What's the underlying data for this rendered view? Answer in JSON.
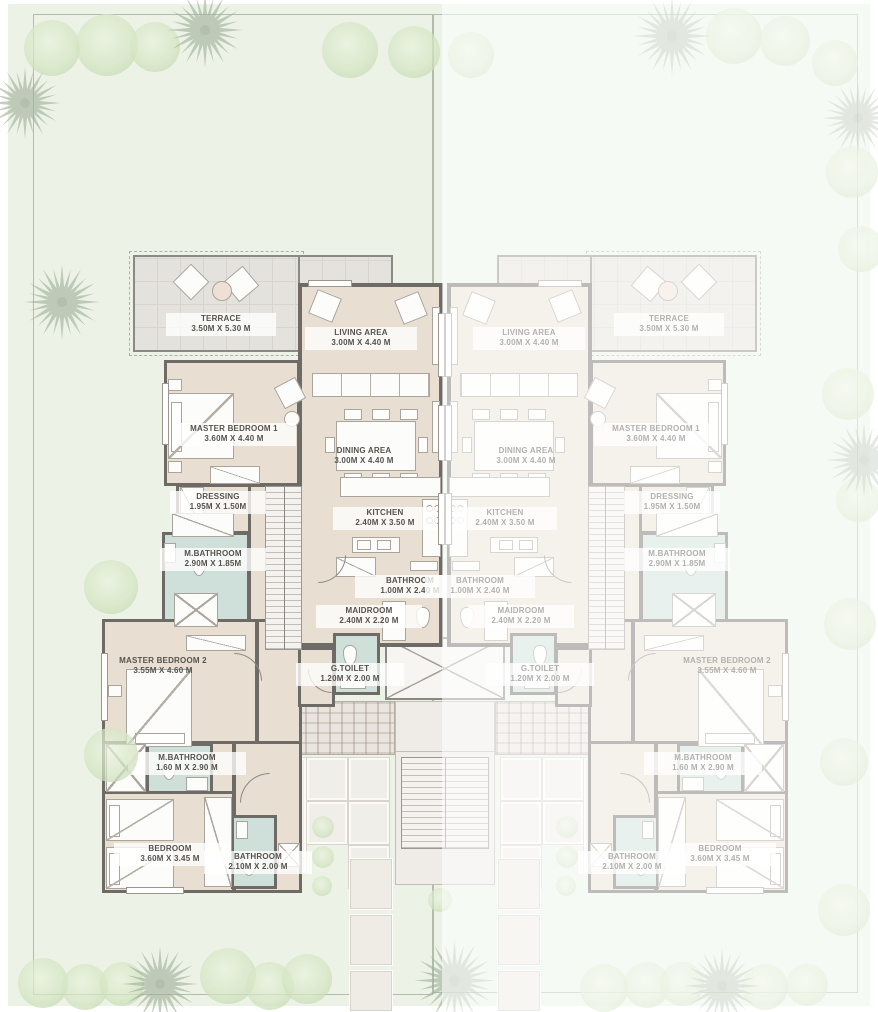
{
  "plan": {
    "title": "villa-floor-plan",
    "units": [
      {
        "id": "unit-left",
        "style": "active"
      },
      {
        "id": "unit-right",
        "style": "ghost-mirrored"
      }
    ],
    "rooms": {
      "terrace": {
        "name": "TERRACE",
        "dims": "3.50M X 5.30 M"
      },
      "living": {
        "name": "LIVING AREA",
        "dims": "3.00M X 4.40 M"
      },
      "master1": {
        "name": "MASTER BEDROOM 1",
        "dims": "3.60M X 4.40 M"
      },
      "dining": {
        "name": "DINING AREA",
        "dims": "3.00M X 4.40 M"
      },
      "dressing": {
        "name": "DRESSING",
        "dims": "1.95M X 1.50M"
      },
      "mbath1": {
        "name": "M.BATHROOM",
        "dims": "2.90M X 1.85M"
      },
      "kitchen": {
        "name": "KITCHEN",
        "dims": "2.40M X 3.50 M"
      },
      "bath1": {
        "name": "BATHROOM",
        "dims": "1.00M X 2.40 M"
      },
      "maid": {
        "name": "MAIDROOM",
        "dims": "2.40M X 2.20 M"
      },
      "master2": {
        "name": "MASTER BEDROOM 2",
        "dims": "3.55M X 4.60 M"
      },
      "gtoilet": {
        "name": "G.TOILET",
        "dims": "1.20M X 2.00 M"
      },
      "mbath2": {
        "name": "M.BATHROOM",
        "dims": "1.60 M X 2.90 M"
      },
      "bedroom": {
        "name": "BEDROOM",
        "dims": "3.60M X 3.45 M"
      },
      "bath2": {
        "name": "BATHROOM",
        "dims": "2.10M X 2.00 M"
      }
    },
    "colors": {
      "plot_green": "#ecf3e6",
      "floor_beige": "#e8dfd2",
      "bathroom_teal": "#cfe0da",
      "terrace_gray": "#e4e2dc",
      "wall_gray": "#6e6b66",
      "tree_green": "#cfe2bd",
      "label_text": "#55524d"
    }
  }
}
